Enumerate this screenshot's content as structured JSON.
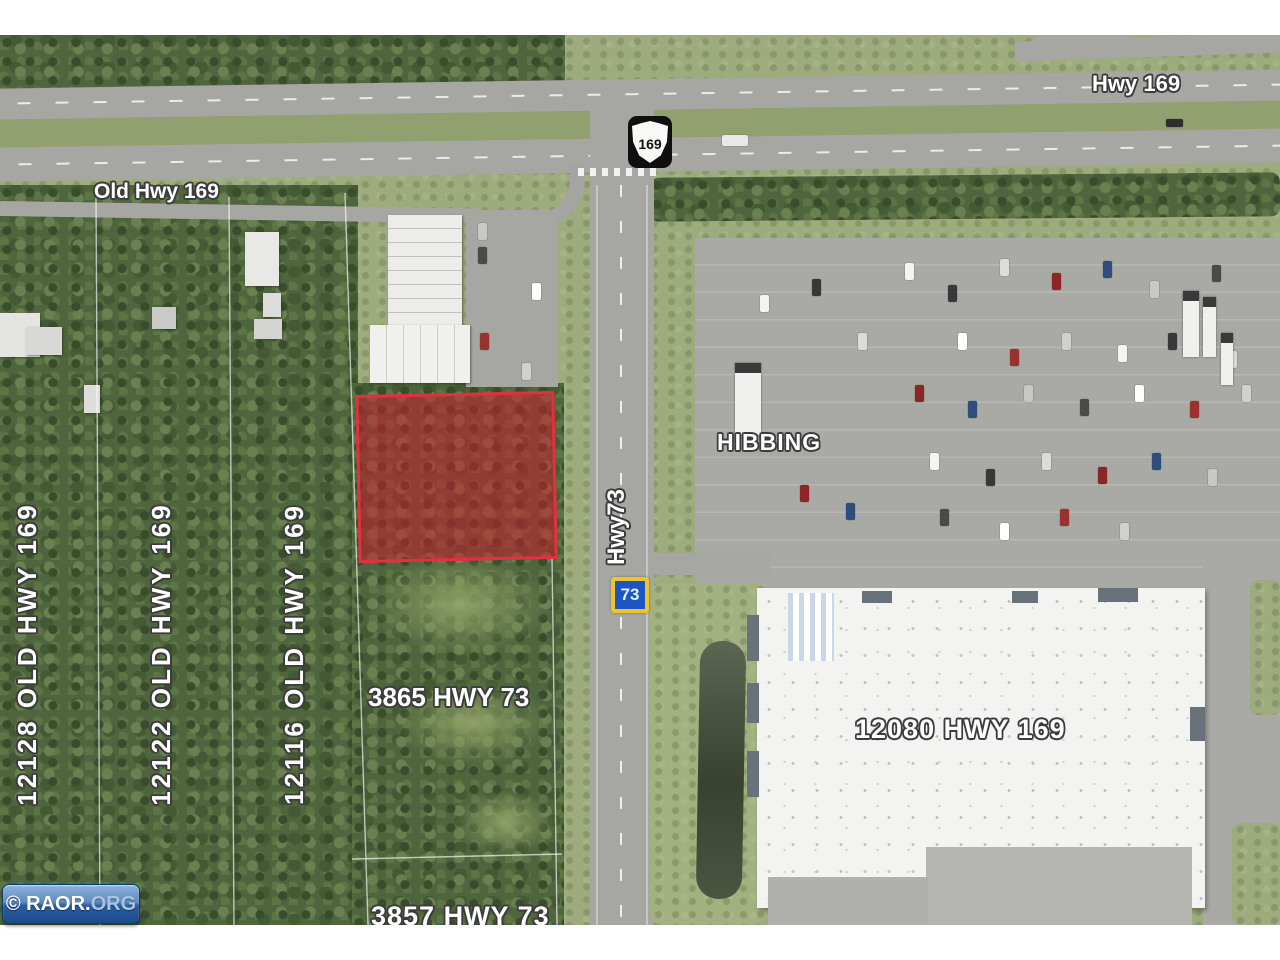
{
  "map": {
    "labels": {
      "hwy_169": "Hwy 169",
      "old_hwy_169": "Old Hwy 169",
      "hibbing": "HIBBING",
      "hwy_73": "Hwy73",
      "parcel_12128": "12128 OLD HWY 169",
      "parcel_12122": "12122 OLD HWY 169",
      "parcel_12116": "12116 OLD HWY 169",
      "parcel_3865": "3865 HWY 73",
      "parcel_3857": "3857 HWY 73",
      "parcel_12080": "12080 HWY 169"
    },
    "shields": {
      "us_169": "169",
      "mn_73": "73"
    },
    "colors": {
      "parcel_highlight_fill": "#c8202d",
      "parcel_highlight_border": "#e2303f",
      "mn_shield_yellow": "#ecc52c",
      "mn_shield_blue": "#1d56c4",
      "watermark_blue_top": "#8fb3da",
      "watermark_blue_bottom": "#1c4b8c"
    }
  },
  "watermark": {
    "prefix": "© RAOR.",
    "suffix": "ORG"
  }
}
